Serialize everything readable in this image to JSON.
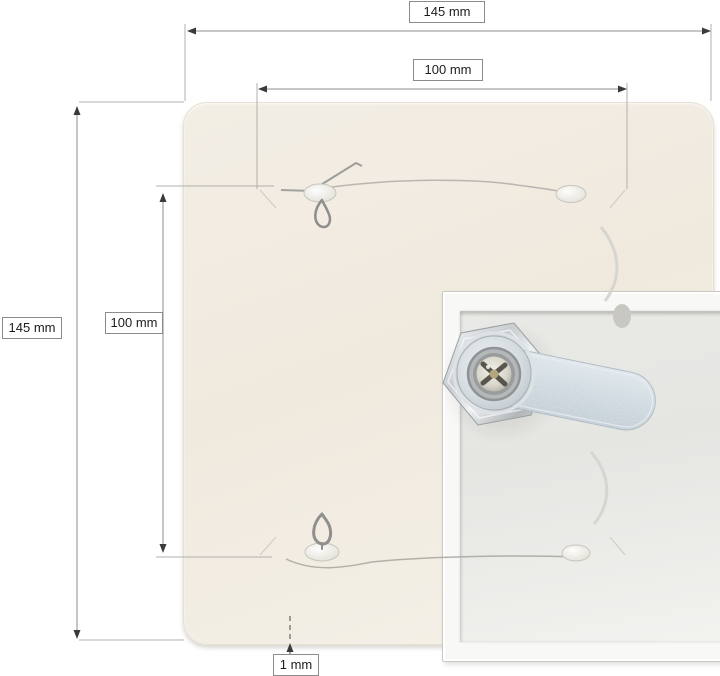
{
  "diagram": {
    "kind": "product-dimension-diagram",
    "subject": "square access panel with cam lock, spring clips and safety pins"
  },
  "dimensions": {
    "outer_width": "145 mm",
    "outer_height": "145 mm",
    "inner_width": "100 mm",
    "inner_height": "100 mm",
    "thickness": "1 mm"
  },
  "colors": {
    "background": "#ffffff",
    "panel_cream": "#f1ebe0",
    "frame_white": "#f8f8f6",
    "door_grey": "#e8e8e5",
    "dimension_line": "#8f8f8f",
    "extension_line": "#b0b0ac",
    "arrowhead": "#3a3a3a",
    "label_border": "#8c8c8c",
    "label_text": "#1c1c1c",
    "cam_arm_zinc": "#c9d4db",
    "lock_chrome": "#d6dadc",
    "screw_brass": "#b3a67c"
  }
}
